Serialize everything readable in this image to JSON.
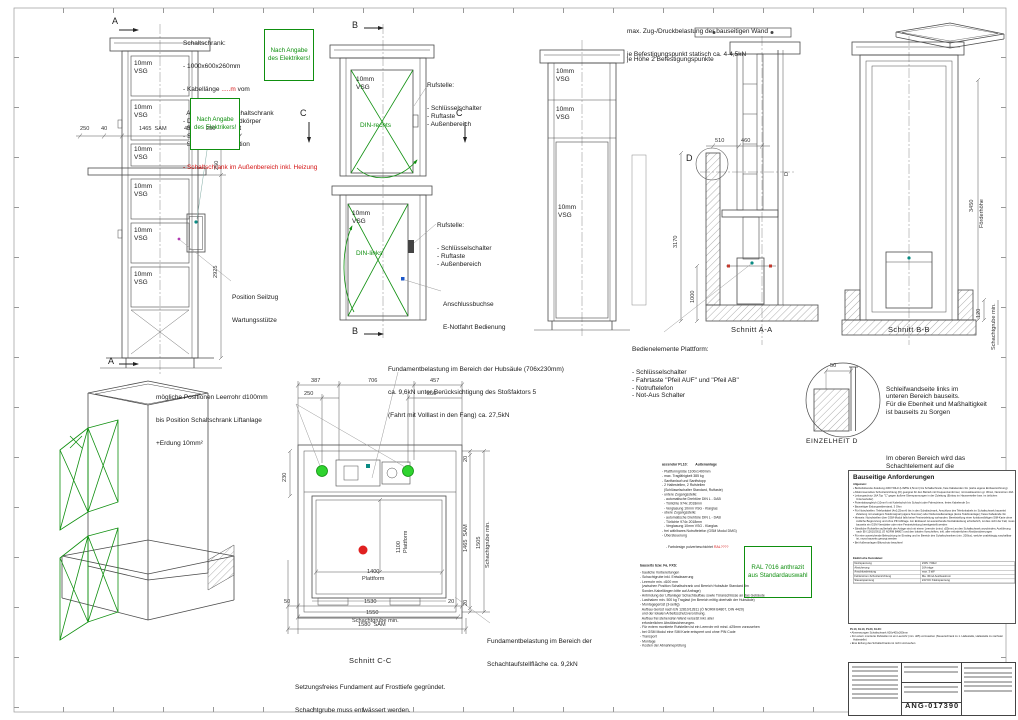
{
  "palette": {
    "green": "#0f8f0f",
    "red": "#d41414",
    "teal": "#0a8b83",
    "line": "#4a4a4a"
  },
  "markers": {
    "a": "A",
    "b": "B",
    "c": "C",
    "d": "D"
  },
  "sections": {
    "aa": "Schnitt A-A",
    "bb": "Schnitt B-B",
    "cc": "Schnitt C-C",
    "detail_d": "EINZELHEIT D"
  },
  "glass": {
    "l1": "10mm",
    "l2": "VSG"
  },
  "doors": {
    "rechts": "DIN-rechts",
    "links": "DIN-links"
  },
  "notes": {
    "schaltschrank": {
      "title": "Schaltschrank:",
      "l1": "- 1000x600x260mm",
      "k_prefix": "- Kabellänge ",
      "k_red": ".....m",
      "k_suffix": " vom",
      "rest": [
        "  Antrieb bis zum Schaltschrank",
        "- Deckel blau, Grundkörper",
        "  Stahlblech verzinkt",
        "- Stromzuleitung zur",
        "  Schaltschrankposition"
      ],
      "red_line": "- Schaltschrank im Außenbereich inkl. Heizung"
    },
    "elektriker": {
      "l1": "Nach Angabe",
      "l2": "des Elektrikers!"
    },
    "wall_load": {
      "l1": "max. Zug-/Druckbelastung der bauseitigen Wand",
      "l2": "je Befestigungspunkt statisch ca. 4-4,5kN",
      "l3": "je Höhe 2 Befestigungspunkte"
    },
    "rufstelle": {
      "title": "Rufstelle:",
      "items": [
        "- Schlüsselschalter",
        "- Ruftaste",
        "- Außenbereich"
      ]
    },
    "anschlussbuchse": {
      "l1": "Anschlussbuchse",
      "l2": "E-Notfahrt Bedienung"
    },
    "seilzug": {
      "l1": "Position Seilzug",
      "l2": "Wartungsstütze"
    },
    "leerrohr": {
      "l1": "mögliche Positionen Leerrohr d100mm",
      "l2": "bis Position Schaltschrank Liftanlage",
      "l3": "+Erdung 10mm²"
    },
    "fund_hubsaeule": {
      "l1": "Fundamentbelastung im Bereich der Hubsäule (706x230mm)",
      "l2": "ca. 9,6kN unter Berücksichtigung des Stoßfaktors 5",
      "l3": "(Fahrt mit Volllast in den Fang) ca. 27,5kN"
    },
    "fund_schacht": {
      "l1": "Fundamentbelastung im Bereich der",
      "l2": "Schachtaufstellfläche ca. 9,2kN"
    },
    "bedienelemente": {
      "title": "Bedienelemente Plattform:",
      "items": [
        "- Schlüsselschalter",
        "- Fahrtaste \"Pfeil AUF\" und \"Pfeil AB\"",
        "- Notruftelefon",
        "- Not-Aus Schalter"
      ]
    },
    "schleifwand": {
      "p1": [
        "Schleifwandseite links im",
        "unteren Bereich bauseits.",
        "Für die Ebenheit und Maßhaltigkeit",
        "ist bauseits zu Sorgen"
      ],
      "p2": [
        "Im oberen Bereich wird das",
        "Schachtelement auf die",
        "bauseitige Wand aufgesetzt."
      ]
    },
    "fundament_bottom": {
      "l1": "Setzungsfreies Fundament auf Frosttiefe gegründet.",
      "l2": "Schachtgrube muss entwässert werden."
    }
  },
  "dims": {
    "left_elev": {
      "h": [
        "250",
        "40",
        "1465  SAM",
        "40",
        "250"
      ],
      "v250": "250",
      "v2925": "2925"
    },
    "aa": {
      "d510": "510",
      "d460": "460",
      "d3170": "3170",
      "d1000": "1000"
    },
    "bb": {
      "d3450": "3450",
      "foerderhoehe": "Förderhöhe",
      "d120": "120",
      "grube": "Schachtgrube min."
    },
    "detail_d": {
      "d50": "50"
    },
    "plan": {
      "top": [
        "387",
        "706",
        "457"
      ],
      "top2": [
        "250",
        "250"
      ],
      "left230": "230",
      "right20a": "20",
      "right_sam": "1465  SAM",
      "right20b": "20",
      "right1505": "1505",
      "right_grube": "Schachtgrube min.",
      "bottom": [
        "50",
        "1530",
        "20"
      ],
      "bottom2_v": "1550",
      "bottom2_t": "Schachtgrube min.",
      "bottom3": "1580  SAM",
      "platform_w_v": "1400",
      "platform_w_t": "Plattform",
      "platform_d_v": "1100",
      "platform_d_t": "Plattform"
    }
  },
  "spec": {
    "header": "ascendor PL10:        Außenanlage",
    "lines": [
      "- Plattformgröße 1100x1400mm",
      "- max. Tragfähigkeit 385 kg",
      "- Sanftanlauf und Sanftstopp",
      "- 2 Haltestellen, 2 Rufstellen",
      "  (Schlüsselschalter Standard, Ruftaste)",
      "- untere Zugangsstelle:",
      "  - automatische Drehtüre DIN L - DAB",
      "  - Türlichte 974x 2018mm",
      "  - Verglasung 10mm VSG - Klarglas",
      "- obere Zugangsstelle:",
      "  - automatische Drehtüre DIN L - DAB",
      "  - Türlichte 974x 2018mm",
      "  - Verglasung 10mm VSG - Klarglas",
      "- frei wählbares Notruftelefon (GSM Modul DMG)",
      "- Übersteuerung"
    ],
    "farbdesign_prefix": "- Farbdesign pulverbeschichtet ",
    "farbdesign_red": "RAL????",
    "ral_box": {
      "l1": "RAL 7016 anthrazit",
      "l2": "aus Standardauswahl"
    },
    "bauseits_header": "bauseits bzw. Fa. FXS:",
    "bauseits_lines": [
      "- bauliche Vorbereitungen",
      "- Schachtgrube inkl. Entwässerung",
      "- Leerrohr min. d100 mm",
      "  (zwischen Position Schaltschrank und Bereich Hubsäule Standard 5m",
      "  Sonder-Kabellängen bitte auf Anfrage)",
      "- Anbindung der Liftanlage/ Schachtaufbau sowie Türanschlüsse an das Gebäude",
      "- Lasthaken min. 500 kg Traglast (im Bereich mittig oberhalb der Hubsäule)",
      "- Montagegerüst (3-seitig)",
      "  Aufbau Gerüst nach EN 12810/12811 (Ö NORM B4807, DIN 4420)",
      "  und der lokalen Arbeitsschutzverordnung.",
      "  Aufbau frei stehend/an Wand versetzt inkl. aller",
      "  erforderlichen Abstützsicherungen.",
      "- Für extern montierte Rufstellen ist ein Leerrohr mit mind. d25mm vorzusehen",
      "- bei GSM Modul eine SIM Karte entsperrt und ohne PIN Code",
      "- Transport",
      "- Montage",
      "- Kosten der Abnahmeprüfung"
    ]
  },
  "requirements": {
    "title": "Bauseitige Anforderungen",
    "subtitle": "Allgemein:",
    "bullets": [
      "Betriebsbereite Zuleitung 230V 50Hz (L/N/PE 2,5mm²) bis Schaltschrank, freie Kabelenden 3m (siehe eigene Einbauzeichnung)",
      "Allstromsensitive Schutzeinrichtung (FI) geeignet für den Betrieb mit Frequenzumformer, mit Auslösestrom gr. 30mA, Nennstrom 40A",
      "Leitungsschutz 16A Typ \"C\" gegen äußere Überspannungen in der Zuleitung (Einbau im Hausverteiler bzw. im örtlichen Unterverteiler)",
      "Potentialausgleich (10mm²) mit Kabelschuh bis Schacht oder Fahrschiene, freies Kabelende 3m",
      "Bauseitiger Erdungswiderstand, 3 Ohm",
      "Für Notrufstellen: Telefonkabel (4x0,25mm²) bis in den Schaltschrank, Anschluss des Telefonkabels im Schaltschrank bauseits! Zuleitung mit analogem Telefonsignal (eigene Nummer) oder Nebenstellenanlage (keine Telefonanlage); freies Kabelende 3m",
      "Hinweis: Notrufstellen über GSM-Modul falls keine Festnetzleitung vorhanden: Bereitstellung einer funktionsfähigen SIM-Karte ohne zeitliche Begrenzung und ohne PIN Abfrage. Am Einbauort ist ausreichende Netzabdeckung erforderlich, ist dies nicht der Fall, muss bauseits ein GSM Verstärker oder eine Festnetzleitung bereitgestellt werden",
      "Sämtliche Rufstellen außerhalb der Anlage sind mit einem Leerrohr (mind. d25mm) an den Schaltschrank anzubinden; Ausführung nach EN 12610/2611 (Ö NORM B4807) und den lokalen Vorschriften, inkl. aller erforderlichen Abstützsicherungen",
      "Für eine ausreichende Beleuchtung im Einstieg und im Bereich des Schaltschrankes (min. 200lux), welche unabhängig zuschaltbar ist, muss bauseits gesorgt werden",
      "Bei Außenanlagen Blitzschutz beachten!"
    ],
    "table_title": "Elektrische Kenndaten:",
    "table": [
      [
        "Netzspannung",
        "230V / 50Hz"
      ],
      [
        "Absicherung",
        "16A träge"
      ],
      [
        "Anschlussleistung",
        "max. 3 kW"
      ],
      [
        "Fehlerstrom-Schutzeinrichtung",
        "Ma. 30mA Auslösestrom"
      ],
      [
        "Steuerspannung",
        "24V DC Kleinspannung"
      ]
    ],
    "pl_title": "PL10, KL10, PL20, KL20:",
    "pl_bullets": [
      "Abmessungen Schaltschrank 600x400x260mm",
      "Für extern montierte Rufstellen ist ein Leerrohr (min. d25) vorzusehen (Steuerschrank zu 1. Haltestelle, Haltestelle zu nächster Haltestelle)",
      "Eine Erdung des Schaltschranks ist nicht vorzusehen"
    ]
  },
  "title_block": {
    "number": "ANG-017390"
  }
}
